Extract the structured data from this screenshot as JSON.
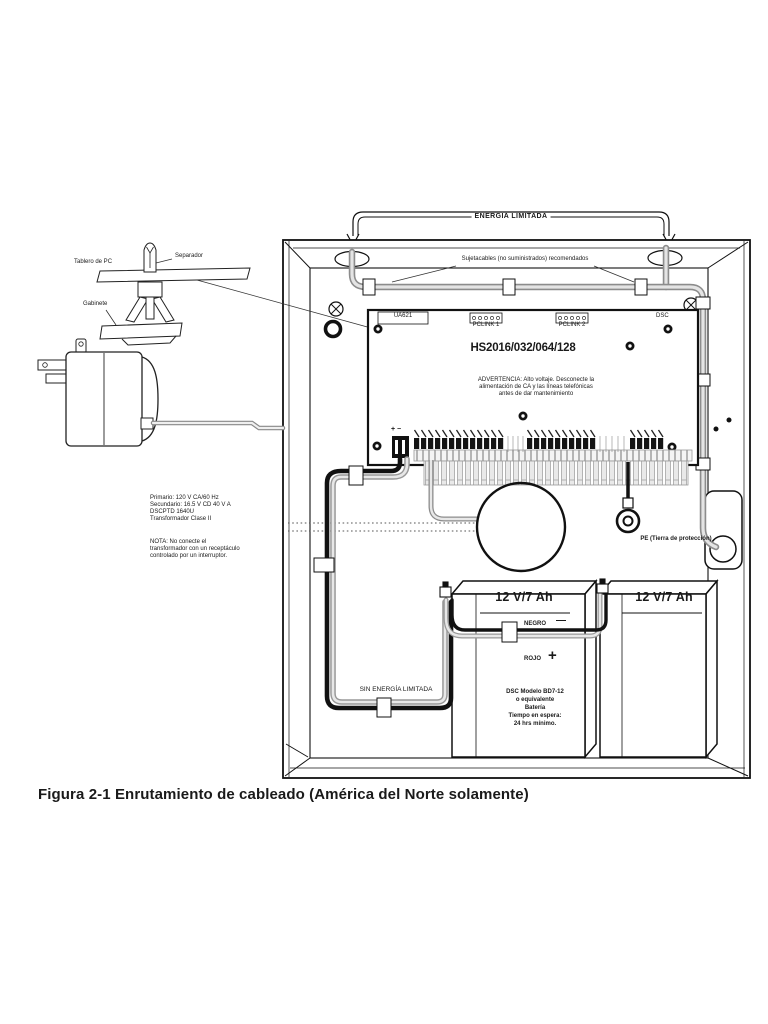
{
  "page": {
    "caption": "Figura 2-1 Enrutamiento de cableado (América del Norte solamente)"
  },
  "diagram": {
    "top_bracket": {
      "label": "ENERGÍA LIMITADA"
    },
    "cable_ties_note": "Sujetacables (no suministrados) recomendados",
    "standoff_detail": {
      "pc_board": "Tablero de PC",
      "standoff": "Separador",
      "cabinet": "Gabinete"
    },
    "board": {
      "sticker": "UA621",
      "pclink1": "PCLINK 1",
      "pclink2": "PCLINK 2",
      "brand": "DSC",
      "model": "HS2016/032/064/128",
      "warning_lines": [
        "ADVERTENCIA: Alto voltaje. Desconecte la",
        "alimentación de CA y las líneas telefónicas",
        "antes de dar mantenimiento"
      ],
      "battery_terminals": "+  −"
    },
    "transformer": {
      "spec_lines": [
        "Primario: 120 V CA/60 Hz",
        "Secundario: 16.5 V CD 40 V A",
        "DSCPTD 1640U",
        "Transformador Clase II"
      ],
      "note_lines": [
        "NOTA: No conecte el",
        "transformador con un receptáculo",
        "controlado por un interruptor."
      ]
    },
    "ground": {
      "label": "PE (Tierra de protección)"
    },
    "wiring": {
      "unlimited_power": "SIN ENERGÍA LIMITADA"
    },
    "batteries": {
      "battery1": {
        "rating": "12 V/7 Ah",
        "negative_label": "NEGRO",
        "negative_symbol": "—",
        "positive_label": "ROJO",
        "positive_symbol": "+",
        "spec_lines": [
          "DSC Modelo BD7-12",
          "o equivalente",
          "Batería",
          "Tiempo en espera:",
          "24 hrs mínimo."
        ]
      },
      "battery2": {
        "rating": "12 V/7 Ah"
      }
    }
  }
}
